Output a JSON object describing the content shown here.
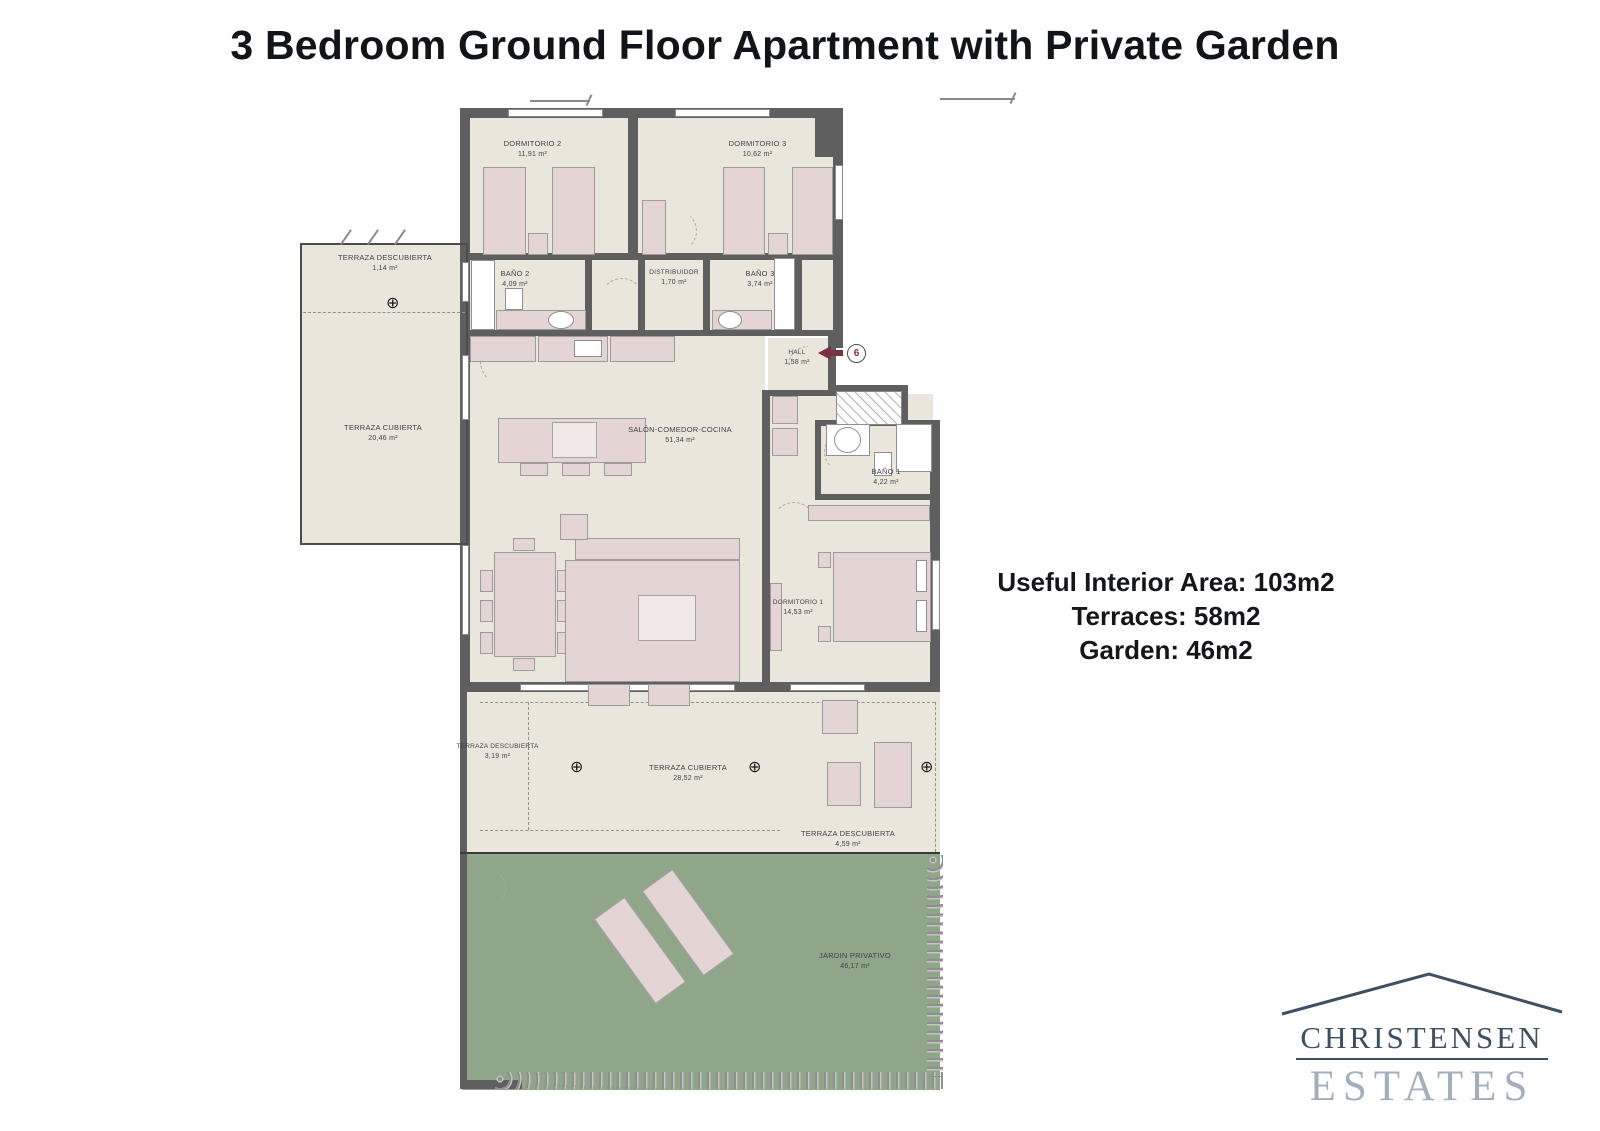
{
  "title": "3 Bedroom Ground Floor Apartment with Private Garden",
  "summary": {
    "line1": "Useful Interior Area: 103m2",
    "line2": "Terraces: 58m2",
    "line3": "Garden: 46m2"
  },
  "entrance": {
    "unit_number": "6"
  },
  "icons": {
    "drain_symbol": "⊕"
  },
  "colors": {
    "wall": "#5F5F5F",
    "floor": "#EAE6DB",
    "furniture": "#E4D5D4",
    "garden": "#8FA689",
    "entry_arrow": "#7C3040",
    "logo_dark": "#3D5063",
    "logo_light": "#A2B0BD"
  },
  "logo": {
    "name": "CHRISTENSEN",
    "type": "ESTATES"
  },
  "rooms": [
    {
      "id": "dormitorio-2",
      "label": "DORMITORIO 2",
      "area": "11,91 m²"
    },
    {
      "id": "dormitorio-3",
      "label": "DORMITORIO 3",
      "area": "10,62 m²"
    },
    {
      "id": "bano-2",
      "label": "BAÑO 2",
      "area": "4,09 m²"
    },
    {
      "id": "distribuidor",
      "label": "DISTRIBUIDOR",
      "area": "1,70 m²"
    },
    {
      "id": "bano-3",
      "label": "BAÑO 3",
      "area": "3,74 m²"
    },
    {
      "id": "terraza-descubierta-top",
      "label": "TERRAZA DESCUBIERTA",
      "area": "1,14 m²"
    },
    {
      "id": "terraza-cubierta-left",
      "label": "TERRAZA CUBIERTA",
      "area": "20,46 m²"
    },
    {
      "id": "salon-comedor-cocina",
      "label": "SALÓN-COMEDOR-COCINA",
      "area": "51,34 m²"
    },
    {
      "id": "hall",
      "label": "HALL",
      "area": "1,58 m²"
    },
    {
      "id": "bano-1",
      "label": "BAÑO 1",
      "area": "4,22 m²"
    },
    {
      "id": "dormitorio-1",
      "label": "DORMITORIO 1",
      "area": "14,53 m²"
    },
    {
      "id": "terraza-descubierta-bl",
      "label": "TERRAZA DESCUBIERTA",
      "area": "3,19 m²"
    },
    {
      "id": "terraza-cubierta-bottom",
      "label": "TERRAZA CUBIERTA",
      "area": "28,52 m²"
    },
    {
      "id": "terraza-descubierta-br",
      "label": "TERRAZA DESCUBIERTA",
      "area": "4,59 m²"
    },
    {
      "id": "jardin-privativo",
      "label": "JARDIN PRIVATIVO",
      "area": "46,17 m²"
    }
  ]
}
